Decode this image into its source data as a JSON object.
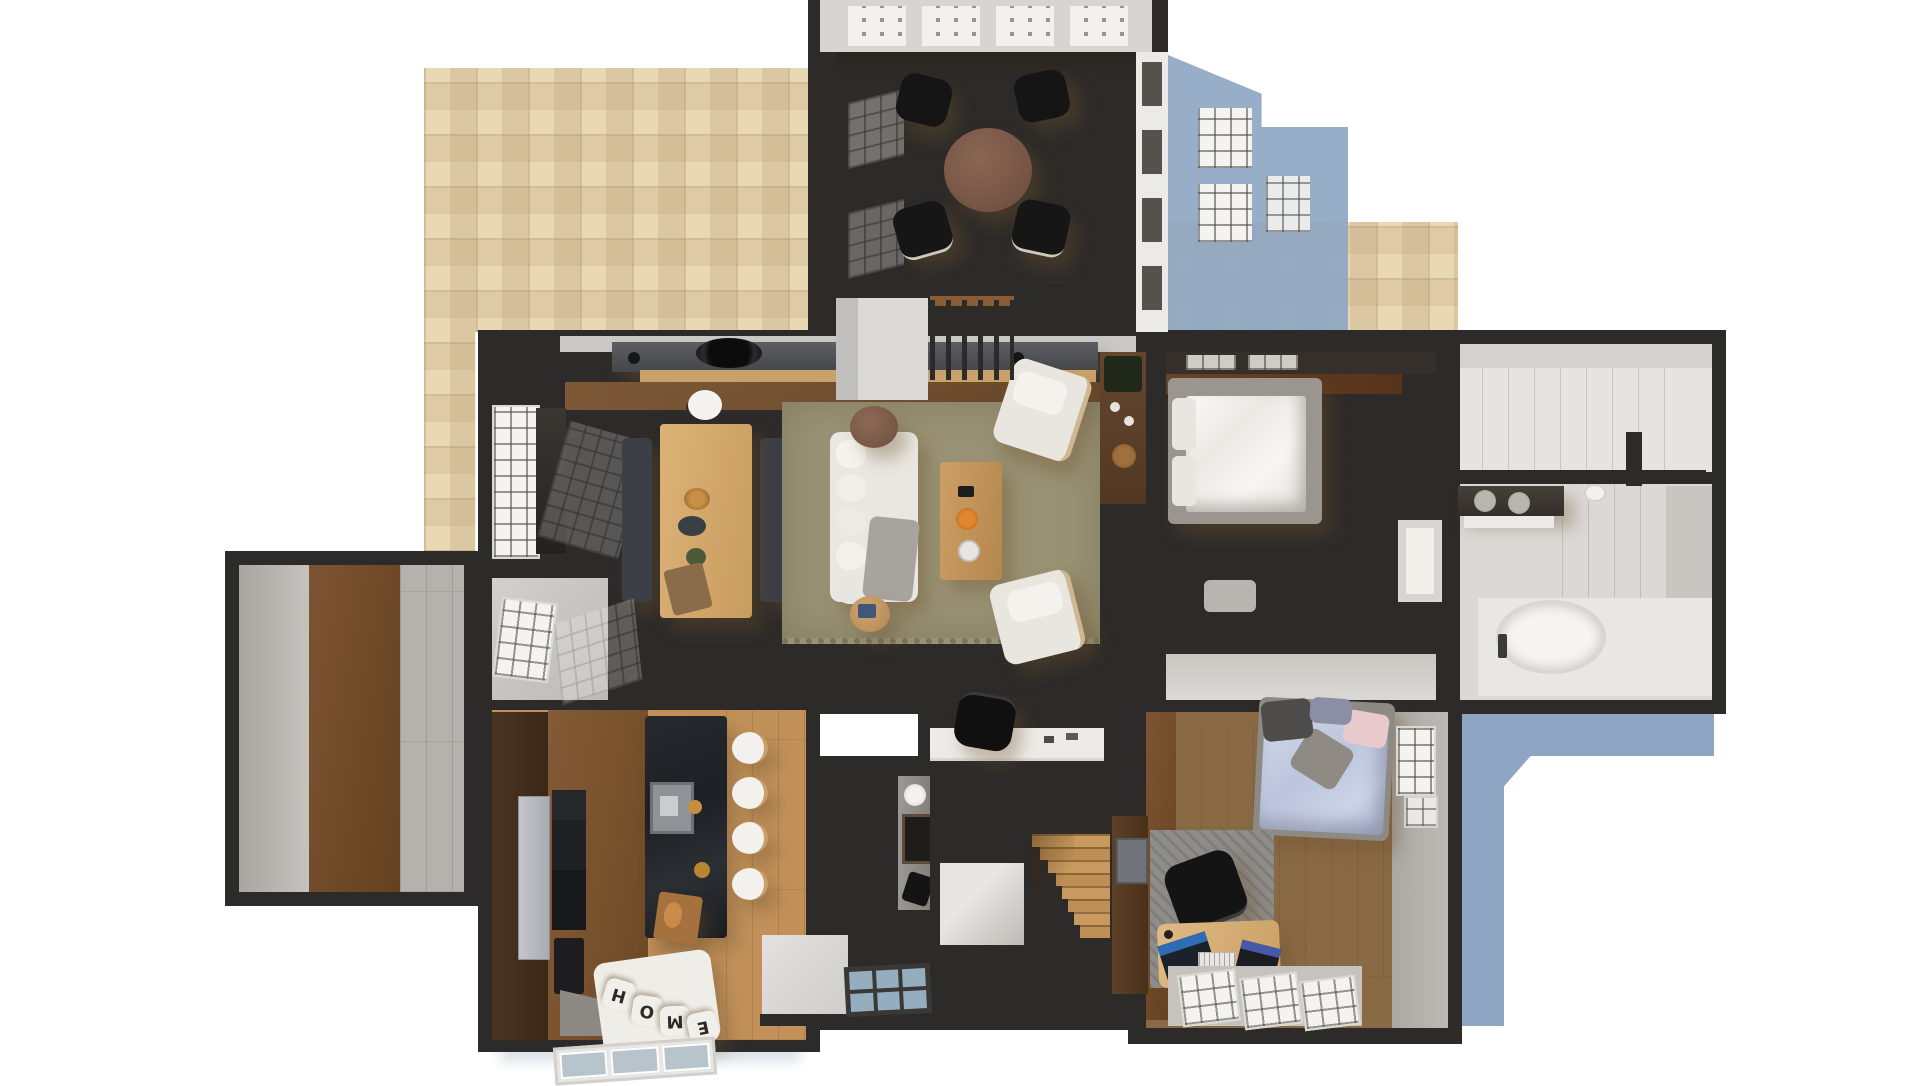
{
  "meta": {
    "title": "Top-down 3D rendered floor plan of a furnished apartment",
    "canvas_w": 1920,
    "canvas_h": 1080
  },
  "palette": {
    "wall": "#2d2b29",
    "oak_floor": "#d6a469",
    "walnut_floor": "#6f4a2c",
    "patio_tile": "#e8d8b4",
    "building_shadow": "#8ea6c3",
    "rug_olive": "#9a9274",
    "island_marble": "#23262a",
    "white_furniture": "#f0efeb",
    "interior_gray": "#b9b6b2"
  },
  "rooms": [
    {
      "id": "sunroom",
      "furniture": [
        "round wood table",
        "4 black cafe chairs",
        "skylight window band"
      ]
    },
    {
      "id": "living-room",
      "furniture": [
        "sideboard with round hearth",
        "dining table",
        "2 bench seats",
        "white sofa",
        "2 round side tables",
        "coffee table",
        "olive rug",
        "2 white armchairs",
        "media console with plant",
        "balcony railing",
        "window bay",
        "desk with black chair"
      ]
    },
    {
      "id": "master-bedroom",
      "furniture": [
        "platform bed with white duvet",
        "bench",
        "white door"
      ]
    },
    {
      "id": "walk-in-closet",
      "furniture": []
    },
    {
      "id": "bathroom",
      "furniture": [
        "double sink vanity",
        "freestanding oval tub",
        "floor faucet",
        "towel roll"
      ]
    },
    {
      "id": "den",
      "furniture": []
    },
    {
      "id": "kitchen",
      "furniture": [
        "black marble island with sink",
        "4 white bar stools",
        "appliance column",
        "fridge",
        "cutting board with bread",
        "window seat bench"
      ]
    },
    {
      "id": "hallway",
      "furniture": [
        "gray wardrobe",
        "mirror",
        "stairwell opening",
        "staircase",
        "striped doormat"
      ]
    },
    {
      "id": "bedroom-2",
      "furniture": [
        "bed with lavender duvet",
        "gray rug",
        "black office chair",
        "desk with two laptops",
        "tall wardrobe",
        "window",
        "bottom window row"
      ]
    }
  ],
  "bench_pillows": {
    "word": "HOME",
    "letters": [
      "H",
      "O",
      "M",
      "E"
    ]
  },
  "exterior": {
    "patio": "travertine tile terrace",
    "shadow": "cast building shadow with window cutouts"
  }
}
